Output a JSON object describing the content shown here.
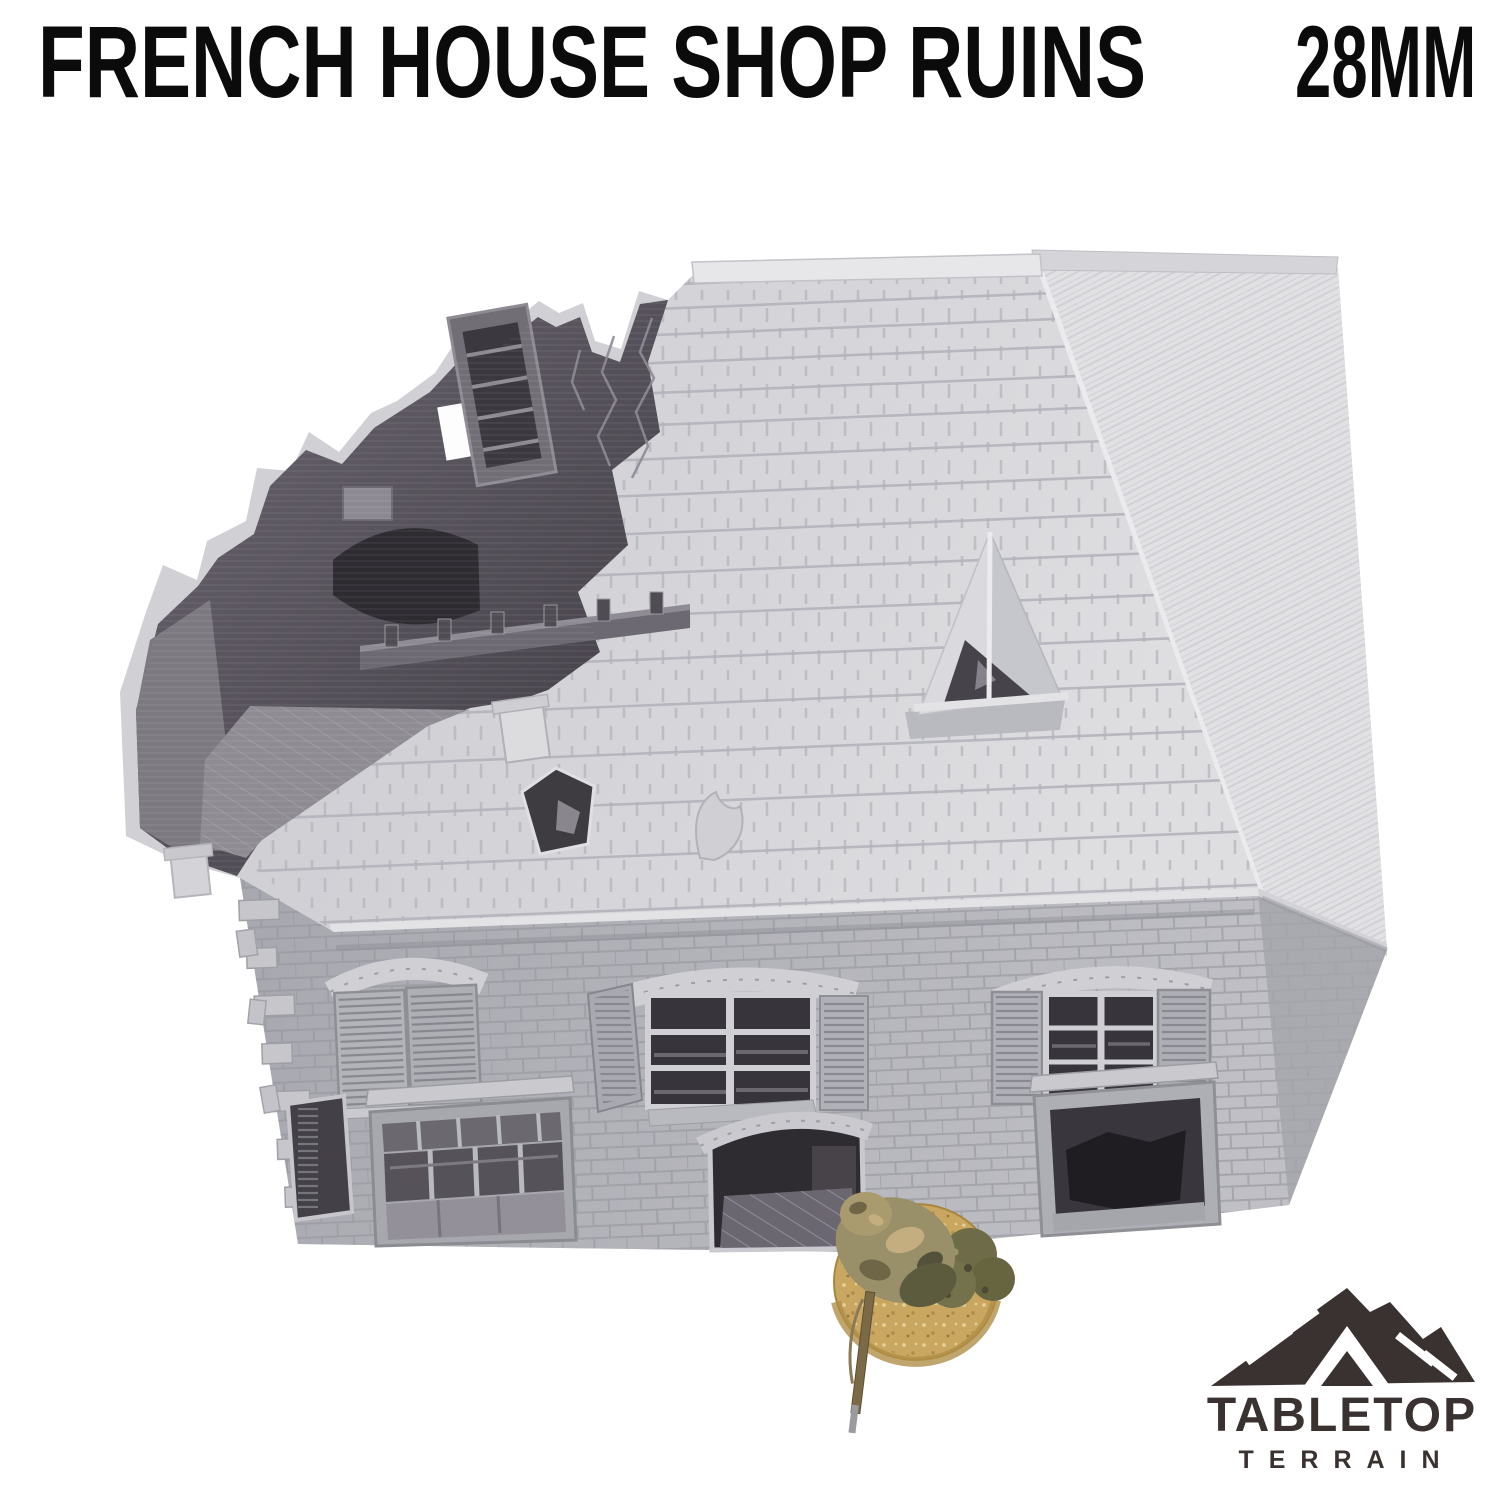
{
  "header": {
    "title": "FRENCH HOUSE SHOP RUINS",
    "scale_label": "28MM"
  },
  "brand": {
    "name_line1": "TABLETOP",
    "name_line2": "TERRAIN"
  },
  "colors": {
    "background": "#ffffff",
    "title_text": "#0b0b0b",
    "brand_dark": "#3a3231",
    "model_roof_light": "#d8d8db",
    "model_wall_gray": "#b5b5bb",
    "model_interior_dark": "#534f57",
    "miniature_base_tan": "#c9a760",
    "miniature_camo_olive": "#99906a"
  }
}
